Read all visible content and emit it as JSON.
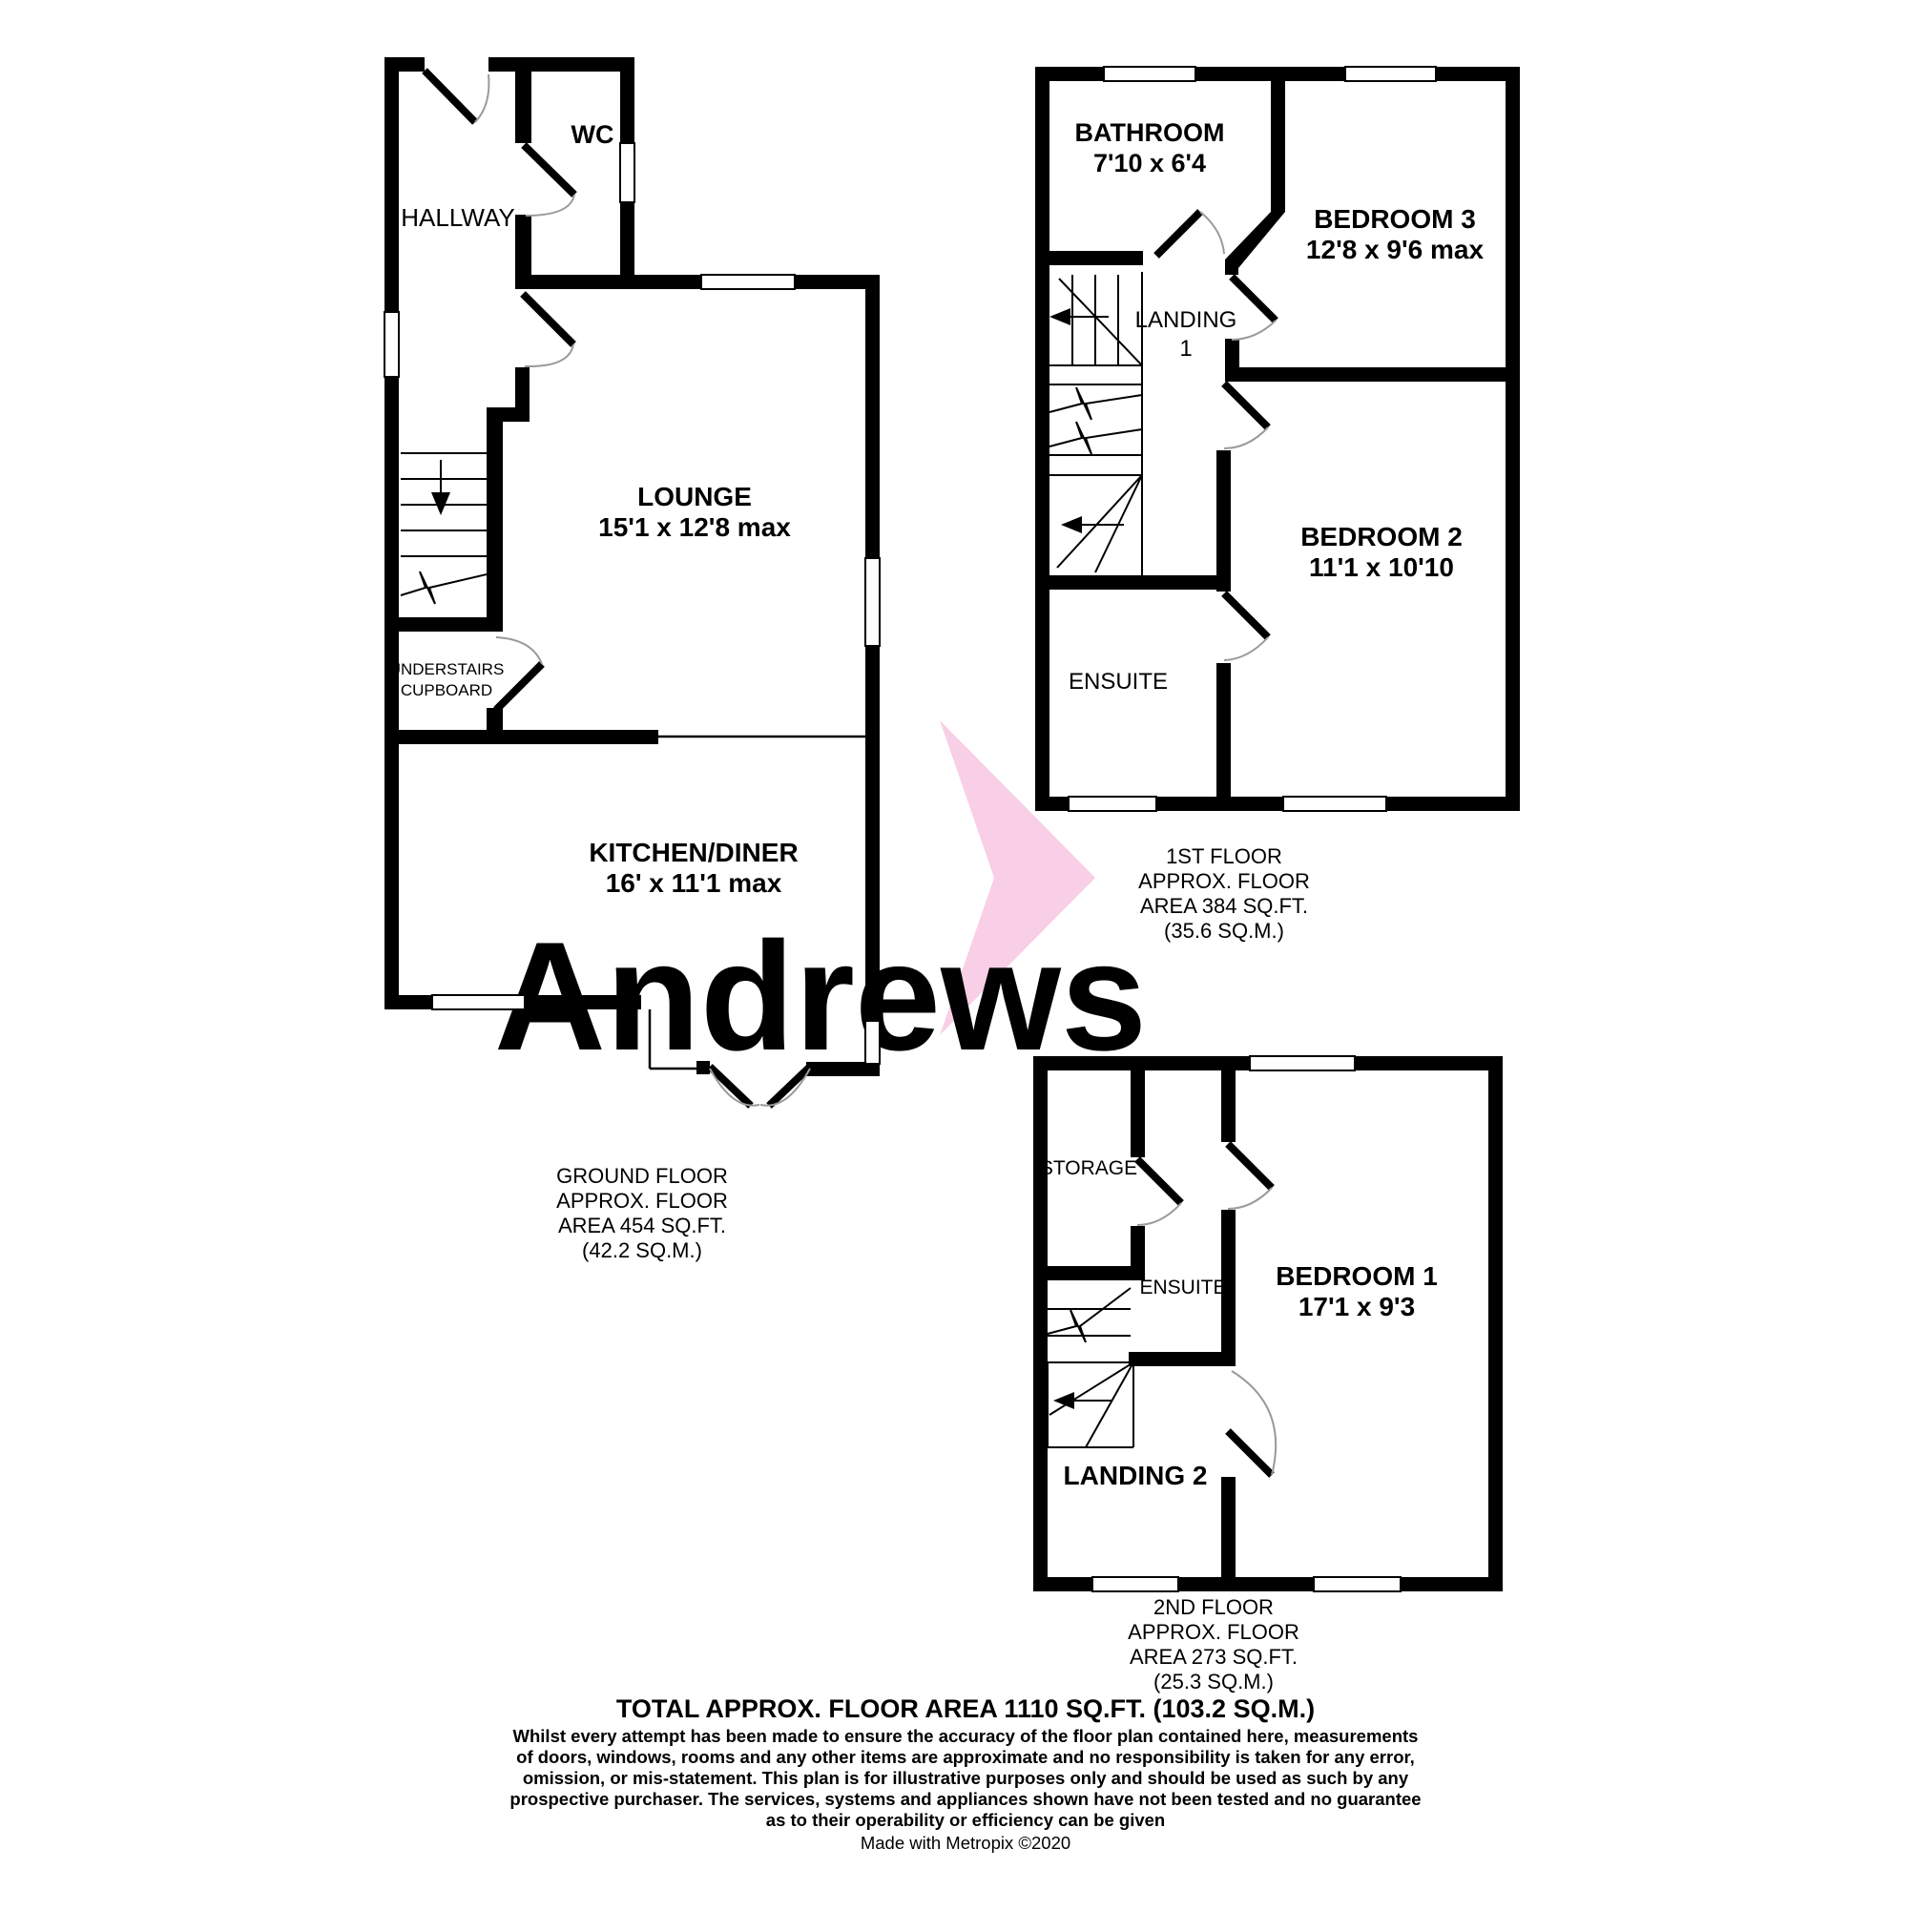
{
  "watermark": {
    "text": "Andrews",
    "text_color": "#f2d8f0",
    "arrow_color": "#f8cfe7"
  },
  "colors": {
    "walls": "#000000",
    "background": "#ffffff",
    "door_arc": "#9a9a9a"
  },
  "floors": {
    "ground": {
      "rooms": {
        "hallway": {
          "name": "HALLWAY"
        },
        "wc": {
          "name": "WC"
        },
        "lounge": {
          "name": "LOUNGE",
          "dims": "15'1 x 12'8 max"
        },
        "understairs": {
          "line1": "UNDERSTAIRS",
          "line2": "CUPBOARD"
        },
        "kitchen": {
          "name": "KITCHEN/DINER",
          "dims": "16' x 11'1 max"
        }
      },
      "summary": [
        "GROUND FLOOR",
        "APPROX. FLOOR",
        "AREA 454 SQ.FT.",
        "(42.2 SQ.M.)"
      ]
    },
    "first": {
      "rooms": {
        "bathroom": {
          "name": "BATHROOM",
          "dims": "7'10 x 6'4"
        },
        "bedroom3": {
          "name": "BEDROOM 3",
          "dims": "12'8 x 9'6 max"
        },
        "landing1": {
          "line1": "LANDING",
          "line2": "1"
        },
        "ensuite": {
          "name": "ENSUITE"
        },
        "bedroom2": {
          "name": "BEDROOM 2",
          "dims": "11'1 x 10'10"
        }
      },
      "summary": [
        "1ST FLOOR",
        "APPROX. FLOOR",
        "AREA 384 SQ.FT.",
        "(35.6 SQ.M.)"
      ]
    },
    "second": {
      "rooms": {
        "storage": {
          "name": "STORAGE"
        },
        "ensuite": {
          "name": "ENSUITE"
        },
        "bedroom1": {
          "name": "BEDROOM 1",
          "dims": "17'1 x 9'3"
        },
        "landing2": {
          "name": "LANDING 2"
        }
      },
      "summary": [
        "2ND FLOOR",
        "APPROX. FLOOR",
        "AREA 273 SQ.FT.",
        "(25.3 SQ.M.)"
      ]
    }
  },
  "footer": {
    "total": "TOTAL APPROX. FLOOR AREA 1110 SQ.FT. (103.2 SQ.M.)",
    "disclaimer": [
      "Whilst every attempt has been made to ensure the accuracy of the floor plan contained here, measurements",
      "of doors, windows, rooms and any other items are approximate and no responsibility is taken for any error,",
      "omission, or mis-statement. This plan is for illustrative purposes only and should be used as such by any",
      "prospective purchaser. The services, systems and appliances shown have not been tested and no guarantee",
      "as to their operability or efficiency can be given"
    ],
    "credit": "Made with Metropix ©2020"
  }
}
